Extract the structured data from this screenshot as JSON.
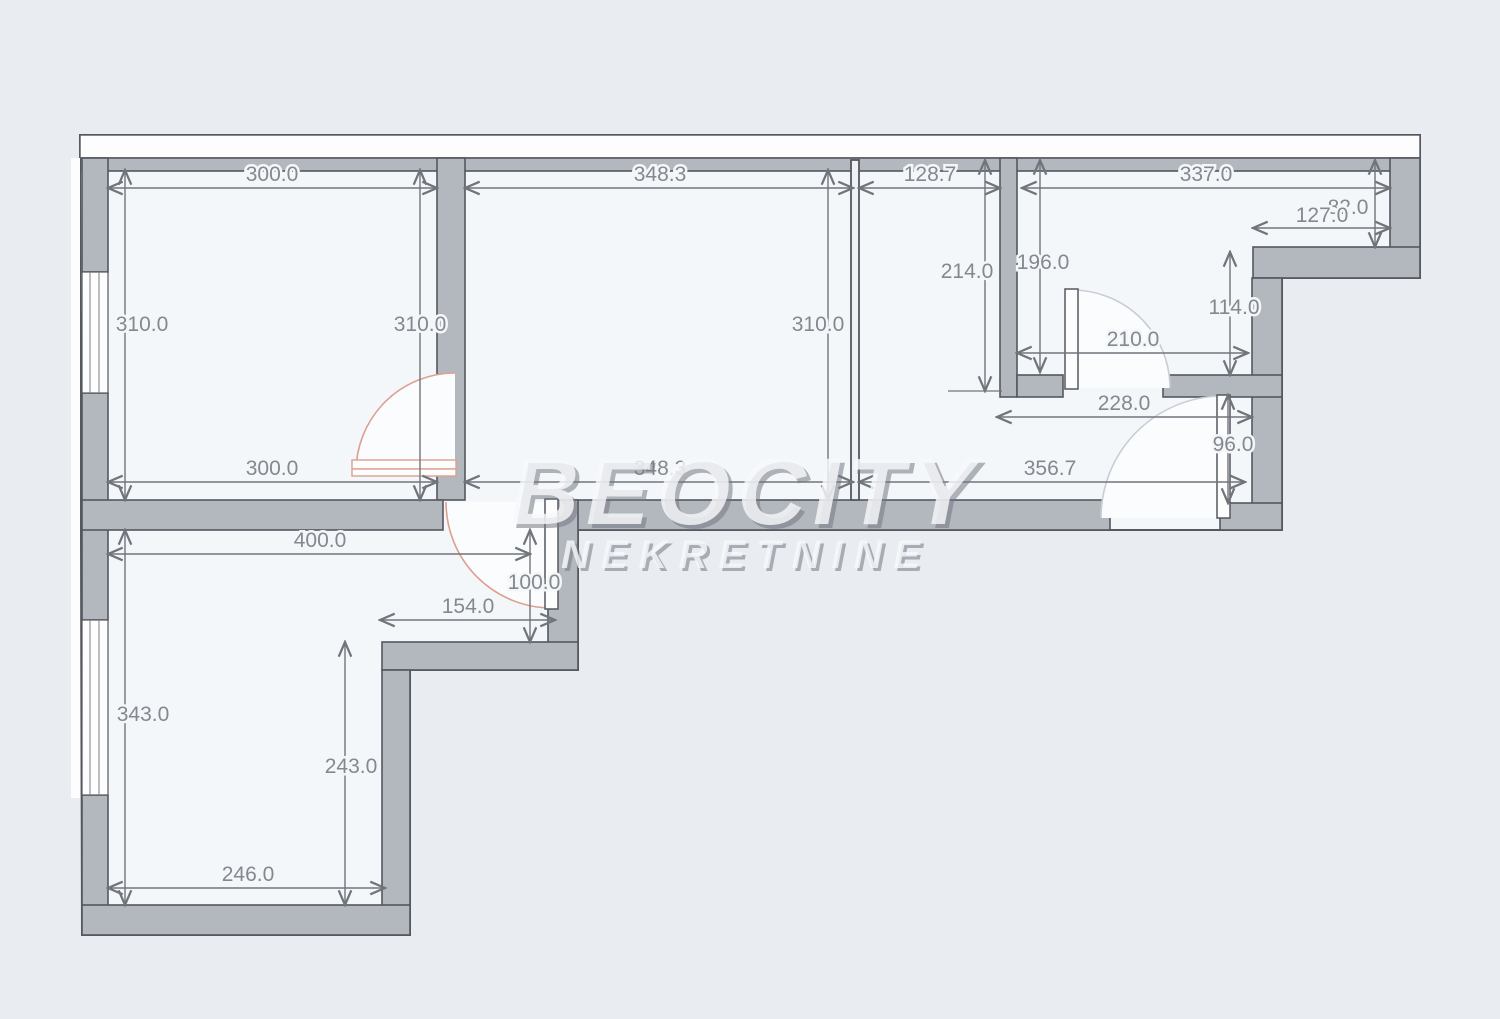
{
  "watermark": {
    "line1": "BEOCITY",
    "line2": "NEKRETNINE"
  },
  "palette": {
    "background": "#e9ecf1",
    "room_interior": "#f4f7fa",
    "wall_gray": "#b3b7be",
    "outline": "#54585f",
    "dimension_text": "#84888f",
    "door_accent": "#dd9f90"
  },
  "dimensions": {
    "room1_top": "300.0",
    "room2_top": "348.3",
    "nook_top": "128.7",
    "room3_top": "337.0",
    "notch_height": "82.0",
    "notch_width": "127.0",
    "room1_left": "310.0",
    "room1_right": "310.0",
    "room2_right": "310.0",
    "nook_depth": "214.0",
    "room3_left": "196.0",
    "room3_inner_right": "114.0",
    "room3_bottom": "210.0",
    "hall_width": "228.0",
    "hall_door": "96.0",
    "corridor_width": "356.7",
    "room1_bottom": "300.0",
    "room2_bottom": "348.3",
    "room4_top": "400.0",
    "room4_step_height": "100.0",
    "room4_step_width": "154.0",
    "room4_left": "343.0",
    "room4_inner_right": "243.0",
    "room4_bottom": "246.0"
  }
}
